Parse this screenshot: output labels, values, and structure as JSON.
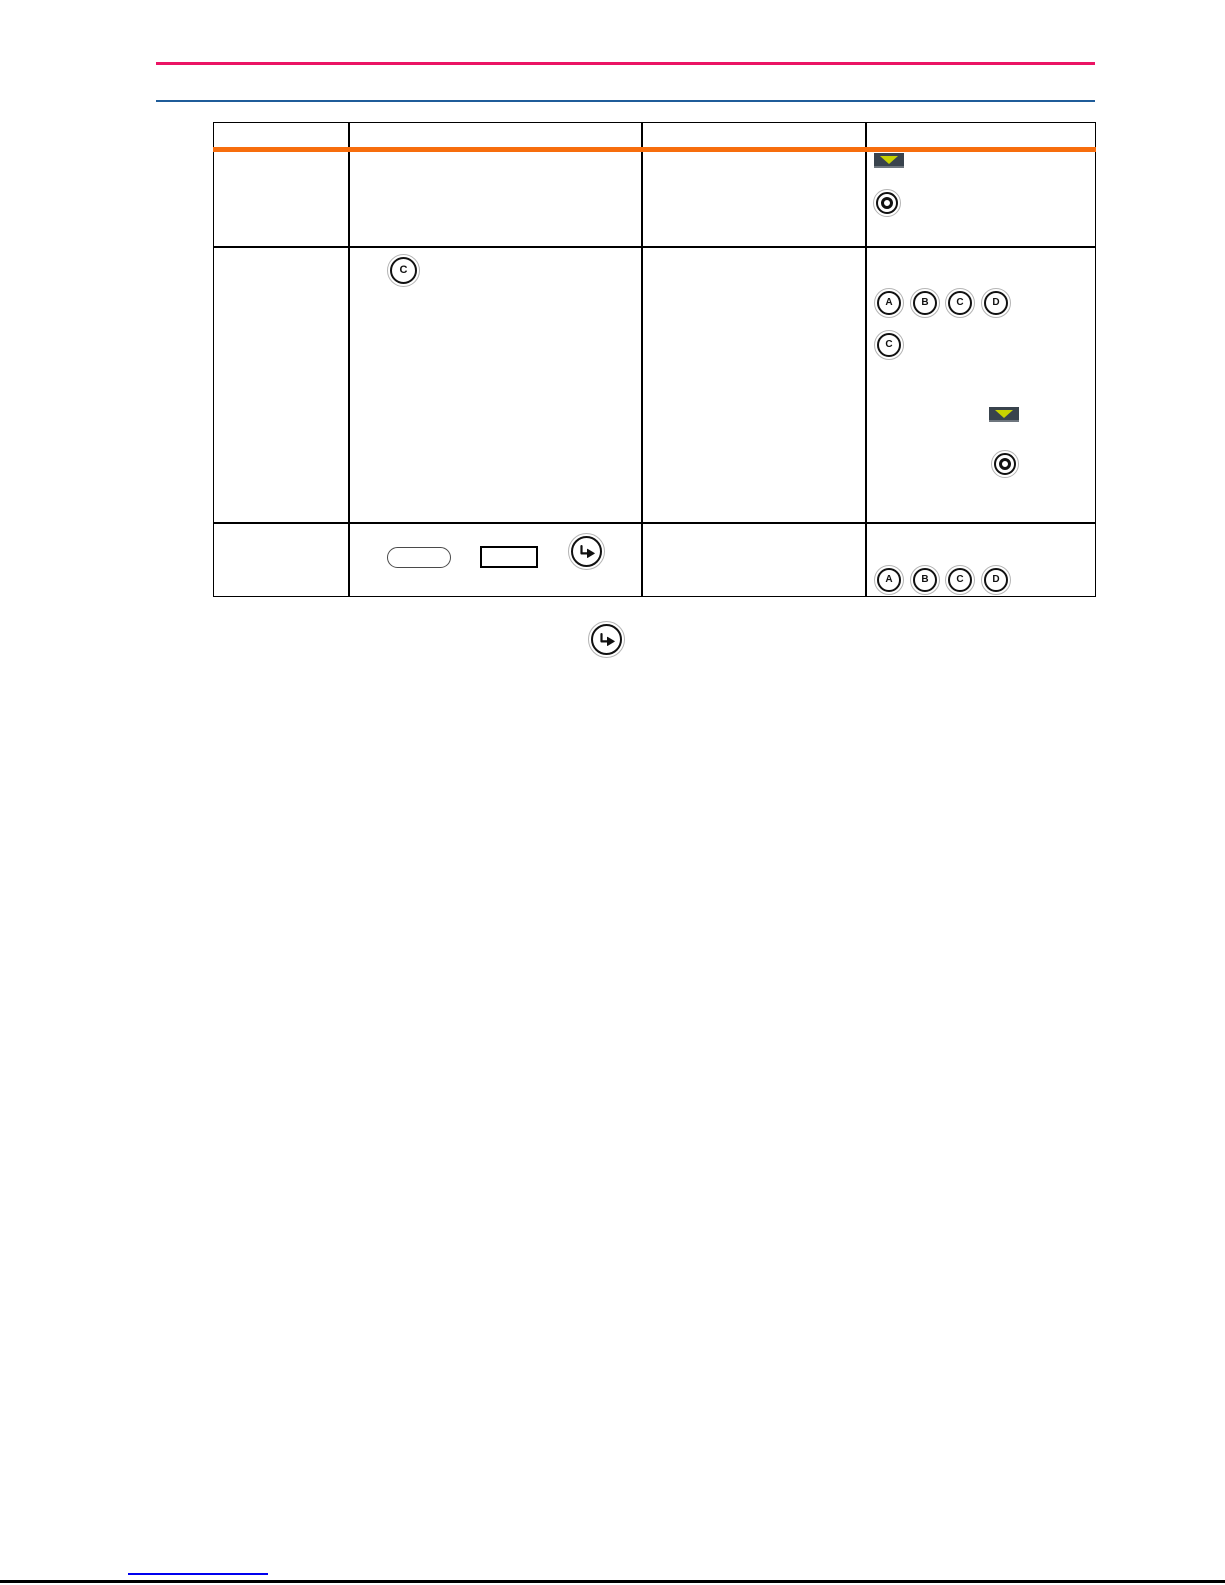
{
  "page": {
    "type": "manual-page",
    "colors": {
      "top_rule": "#EB1464",
      "secondary_rule": "#1F5C99",
      "table_header_accent": "#F76D0D",
      "table_border": "#000000",
      "footer_link_underline": "#0000EE",
      "footer_rule": "#000000",
      "arrow_key_background": "#39434D",
      "arrow_key_triangle": "#C8D200"
    }
  },
  "controls": {
    "letter_buttons": [
      "A",
      "B",
      "C",
      "D"
    ],
    "single_letter": "C",
    "icons": {
      "arrow_down": "arrow-down-key",
      "ring": "concentric-ring-key",
      "enter": "enter-arrow-key",
      "pill": "pill-outline",
      "rect": "rectangle-outline"
    }
  },
  "table": {
    "column_count": 4,
    "rows": [
      {
        "name": "row-1",
        "cells": [
          {
            "icons": []
          },
          {
            "icons": []
          },
          {
            "icons": []
          },
          {
            "icons": [
              "arrow-down-key",
              "concentric-ring-key"
            ]
          }
        ]
      },
      {
        "name": "row-2",
        "cells": [
          {
            "icons": []
          },
          {
            "icons": [
              "letter-key-C"
            ]
          },
          {
            "icons": []
          },
          {
            "icons": [
              "letter-key-A",
              "letter-key-B",
              "letter-key-C",
              "letter-key-D",
              "letter-key-C",
              "arrow-down-key",
              "concentric-ring-key"
            ]
          }
        ]
      },
      {
        "name": "row-3",
        "cells": [
          {
            "icons": []
          },
          {
            "icons": [
              "pill-outline",
              "rectangle-outline",
              "enter-arrow-key"
            ]
          },
          {
            "icons": []
          },
          {
            "icons": [
              "letter-key-A",
              "letter-key-B",
              "letter-key-C",
              "letter-key-D"
            ]
          }
        ]
      }
    ]
  },
  "below_table": {
    "icons": [
      "enter-arrow-key"
    ]
  },
  "footer": {
    "link_text": ""
  }
}
